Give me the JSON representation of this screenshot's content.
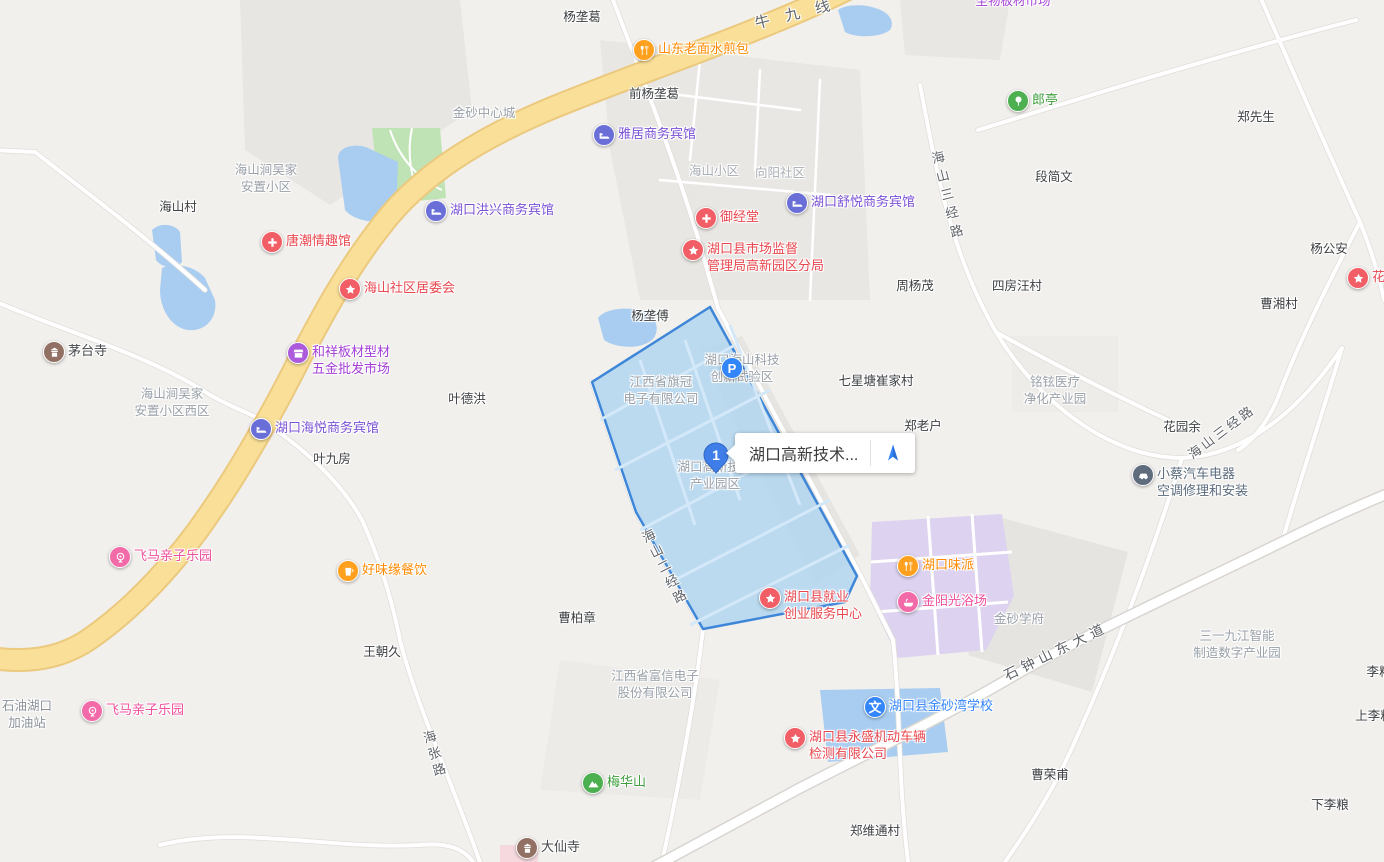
{
  "app": {
    "name": "web-map",
    "language": "zh-CN"
  },
  "colors": {
    "accent_blue": "#3385FA",
    "highlight_fill": "#AED4F0",
    "highlight_border": "#3E86D8",
    "yellow_road": "#F9DF97",
    "water": "#A9CDF1",
    "park_green": "#BFE3B4",
    "purple_zone": "#DDD2EF",
    "hotel": "#6A6FD8",
    "hotel_text": "#7B52D6",
    "red_poi": "#F25E66",
    "red_text": "#E8474E",
    "orange_poi": "#FFA11F",
    "orange_text": "#FF8A00",
    "pink_poi": "#F26BA8",
    "pink_text": "#F0509C",
    "green_poi": "#4CAF50",
    "green_text": "#3E9E3C",
    "purple_poi": "#AB5BDC",
    "purple_text": "#A43ED6",
    "brown_poi": "#927164",
    "temple_text": "#44474B",
    "slate_poi": "#5E6C7E",
    "slate_text": "#5B6B7D"
  },
  "selection": {
    "callout_text": "湖口高新技术...",
    "marker_number": "1",
    "highlighted_area_lines": [
      "湖口高新技术",
      "产业园区"
    ]
  },
  "pois": [
    {
      "icon": "utensils",
      "name": "shandong-laomian-shuijianbao",
      "color": "#FFA11F",
      "label_color": "#FF8A00",
      "x": 644,
      "y": 50,
      "lines": [
        "山东老面水煎包"
      ]
    },
    {
      "icon": "bed",
      "name": "yaju-hotel",
      "color": "#6A6FD8",
      "label_color": "#7B52D6",
      "x": 604,
      "y": 135,
      "lines": [
        "雅居商务宾馆"
      ]
    },
    {
      "icon": "bed",
      "name": "hukou-shuyue-hotel",
      "color": "#6A6FD8",
      "label_color": "#7B52D6",
      "x": 797,
      "y": 203,
      "lines": [
        "湖口舒悦商务宾馆"
      ]
    },
    {
      "icon": "cross",
      "name": "yujingtang",
      "color": "#F25E66",
      "label_color": "#E8474E",
      "x": 706,
      "y": 218,
      "lines": [
        "御经堂"
      ]
    },
    {
      "icon": "star",
      "name": "market-supervision-branch",
      "color": "#F25E66",
      "label_color": "#E8474E",
      "x": 693,
      "y": 250,
      "lines": [
        "湖口县市场监督",
        "管理局高新园区分局"
      ]
    },
    {
      "icon": "bed",
      "name": "hukou-hongxing-hotel",
      "color": "#6A6FD8",
      "label_color": "#7B52D6",
      "x": 436,
      "y": 211,
      "lines": [
        "湖口洪兴商务宾馆"
      ]
    },
    {
      "icon": "cross",
      "name": "tangchao-shop",
      "color": "#F25E66",
      "label_color": "#E8474E",
      "x": 272,
      "y": 242,
      "lines": [
        "唐潮情趣馆"
      ]
    },
    {
      "icon": "star",
      "name": "haishan-community-committee",
      "color": "#F25E66",
      "label_color": "#E8474E",
      "x": 350,
      "y": 289,
      "lines": [
        "海山社区居委会"
      ]
    },
    {
      "icon": "pagoda",
      "name": "maotai-temple",
      "color": "#927164",
      "label_color": "#44474B",
      "x": 54,
      "y": 352,
      "lines": [
        "茅台寺"
      ]
    },
    {
      "icon": "shop",
      "name": "hexiang-building-materials-market",
      "color": "#AB5BDC",
      "label_color": "#A43ED6",
      "x": 298,
      "y": 353,
      "lines": [
        "和祥板材型材",
        "五金批发市场"
      ]
    },
    {
      "icon": "bed",
      "name": "hukou-haiyue-hotel",
      "color": "#6A6FD8",
      "label_color": "#7B52D6",
      "x": 261,
      "y": 429,
      "lines": [
        "湖口海悦商务宾馆"
      ]
    },
    {
      "icon": "tree",
      "name": "langting",
      "color": "#4CAF50",
      "label_color": "#3E9E3C",
      "x": 1018,
      "y": 101,
      "lines": [
        "郎亭"
      ]
    },
    {
      "icon": "star",
      "name": "huatian-clipped",
      "color": "#F25E66",
      "label_color": "#E8474E",
      "x": 1358,
      "y": 278,
      "lines": [
        "花田"
      ]
    },
    {
      "icon": "ferris",
      "name": "feima-kids-park-north",
      "color": "#F26BA8",
      "label_color": "#F0509C",
      "x": 120,
      "y": 557,
      "lines": [
        "飞马亲子乐园"
      ]
    },
    {
      "icon": "cup",
      "name": "haoweiyuan-catering",
      "color": "#FFA11F",
      "label_color": "#FF8A00",
      "x": 348,
      "y": 571,
      "lines": [
        "好味缘餐饮"
      ]
    },
    {
      "icon": "utensils",
      "name": "hukou-weipai",
      "color": "#FFA11F",
      "label_color": "#FF8A00",
      "x": 908,
      "y": 566,
      "lines": [
        "湖口味派"
      ]
    },
    {
      "icon": "bath",
      "name": "jinyangguang-bathhouse",
      "color": "#F26BA8",
      "label_color": "#F0509C",
      "x": 908,
      "y": 602,
      "lines": [
        "金阳光浴场"
      ]
    },
    {
      "icon": "star",
      "name": "employment-service-center",
      "color": "#F25E66",
      "label_color": "#E8474E",
      "x": 770,
      "y": 598,
      "lines": [
        "湖口县就业",
        "创业服务中心"
      ]
    },
    {
      "icon": "ferris",
      "name": "feima-kids-park-south",
      "color": "#F26BA8",
      "label_color": "#F0509C",
      "x": 92,
      "y": 711,
      "lines": [
        "飞马亲子乐园"
      ]
    },
    {
      "icon": "wen",
      "name": "jinshawan-school",
      "color": "#3385FA",
      "label_color": "#3385FA",
      "x": 875,
      "y": 707,
      "lines": [
        "湖口县金砂湾学校"
      ],
      "glyph": "文"
    },
    {
      "icon": "star",
      "name": "yongsheng-vehicle-inspection",
      "color": "#F25E66",
      "label_color": "#E8474E",
      "x": 795,
      "y": 738,
      "lines": [
        "湖口县永盛机动车辆",
        "检测有限公司"
      ]
    },
    {
      "icon": "mountain",
      "name": "meihuashan",
      "color": "#4CAF50",
      "label_color": "#3E9E3C",
      "x": 593,
      "y": 783,
      "lines": [
        "梅华山"
      ]
    },
    {
      "icon": "pagoda",
      "name": "daxian-temple",
      "color": "#927164",
      "label_color": "#44474B",
      "x": 527,
      "y": 848,
      "lines": [
        "大仙寺"
      ]
    },
    {
      "icon": "car",
      "name": "xiaocai-auto-electric",
      "color": "#5E6C7E",
      "label_color": "#5B6B7D",
      "x": 1143,
      "y": 475,
      "lines": [
        "小蔡汽车电器",
        "空调修理和安装"
      ]
    },
    {
      "icon": "parking",
      "name": "parking-lot",
      "color": "#3385FA",
      "label_color": "#3385FA",
      "x": 732,
      "y": 368,
      "lines": [],
      "glyph": "P"
    }
  ],
  "place_labels": [
    {
      "text": "杨垄葛",
      "x": 582,
      "y": 6
    },
    {
      "text": "前杨垄葛",
      "x": 654,
      "y": 83
    },
    {
      "text": "海山村",
      "x": 178,
      "y": 196
    },
    {
      "text": "杨垄傅",
      "x": 650,
      "y": 305
    },
    {
      "text": "周杨茂",
      "x": 915,
      "y": 275
    },
    {
      "text": "段简文",
      "x": 1054,
      "y": 166
    },
    {
      "text": "郑先生",
      "x": 1256,
      "y": 106
    },
    {
      "text": "杨公安",
      "x": 1329,
      "y": 238
    },
    {
      "text": "曹湘村",
      "x": 1279,
      "y": 293
    },
    {
      "text": "四房汪村",
      "x": 1017,
      "y": 275
    },
    {
      "text": "七星塘崔家村",
      "x": 876,
      "y": 370
    },
    {
      "text": "郑老户",
      "x": 923,
      "y": 415
    },
    {
      "text": "花园余",
      "x": 1182,
      "y": 416
    },
    {
      "text": "叶德洪",
      "x": 467,
      "y": 388
    },
    {
      "text": "叶九房",
      "x": 332,
      "y": 448
    },
    {
      "text": "王朝久",
      "x": 382,
      "y": 641
    },
    {
      "text": "曹柏章",
      "x": 577,
      "y": 607
    },
    {
      "text": "郑维通村",
      "x": 875,
      "y": 820
    },
    {
      "text": "曹荣甫",
      "x": 1050,
      "y": 764
    },
    {
      "text": "下李粮",
      "x": 1330,
      "y": 794
    },
    {
      "text": "上李粮",
      "x": 1374,
      "y": 705
    },
    {
      "text": "李粮",
      "x": 1379,
      "y": 661
    }
  ],
  "district_labels": [
    {
      "lines": [
        "金砂中心城"
      ],
      "x": 484,
      "y": 105
    },
    {
      "lines": [
        "海山涧吴家",
        "安置小区"
      ],
      "x": 266,
      "y": 162
    },
    {
      "lines": [
        "海山小区"
      ],
      "x": 714,
      "y": 163,
      "color": "#A8AEB5"
    },
    {
      "lines": [
        "向阳社区"
      ],
      "x": 780,
      "y": 165,
      "color": "#A8AEB5"
    },
    {
      "lines": [
        "海山涧吴家",
        "安置小区西区"
      ],
      "x": 172,
      "y": 386
    },
    {
      "lines": [
        "江西省旗冠",
        "电子有限公司"
      ],
      "x": 661,
      "y": 374
    },
    {
      "lines": [
        "湖口海山科技",
        "创新试验区"
      ],
      "x": 742,
      "y": 352
    },
    {
      "lines": [
        "湖口高新技术",
        "产业园区"
      ],
      "x": 715,
      "y": 459
    },
    {
      "lines": [
        "江西省富信电子",
        "股份有限公司"
      ],
      "x": 655,
      "y": 668
    },
    {
      "lines": [
        "铭铉医疗",
        "净化产业园"
      ],
      "x": 1055,
      "y": 374
    },
    {
      "lines": [
        "三一九江智能",
        "制造数字产业园"
      ],
      "x": 1237,
      "y": 628
    },
    {
      "lines": [
        "金砂学府"
      ],
      "x": 1019,
      "y": 611
    },
    {
      "lines": [
        "石油湖口",
        "加油站"
      ],
      "x": 27,
      "y": 698,
      "color": "#8A9199"
    },
    {
      "lines": [
        "圣物板材市场"
      ],
      "x": 1013,
      "y": -7,
      "color": "#A43ED6"
    }
  ],
  "road_labels": [
    {
      "text": "牛九线",
      "x": 800,
      "y": 12,
      "rot": -14,
      "ls": 16,
      "size": 15,
      "vertical": false
    },
    {
      "text": "海山三经路",
      "x": 947,
      "y": 197,
      "rot": -14,
      "ls": 6,
      "size": 13,
      "vertical": true
    },
    {
      "text": "海山三经路",
      "x": 1221,
      "y": 431,
      "rot": -37,
      "ls": 3,
      "size": 13,
      "vertical": false
    },
    {
      "text": "海山二经路",
      "x": 664,
      "y": 568,
      "rot": -27,
      "ls": 4,
      "size": 13,
      "vertical": true
    },
    {
      "text": "石钟山东大道",
      "x": 1056,
      "y": 651,
      "rot": -26,
      "ls": 5,
      "size": 14,
      "vertical": false
    },
    {
      "text": "海张路",
      "x": 434,
      "y": 755,
      "rot": -16,
      "ls": 4,
      "size": 13,
      "vertical": true
    }
  ]
}
